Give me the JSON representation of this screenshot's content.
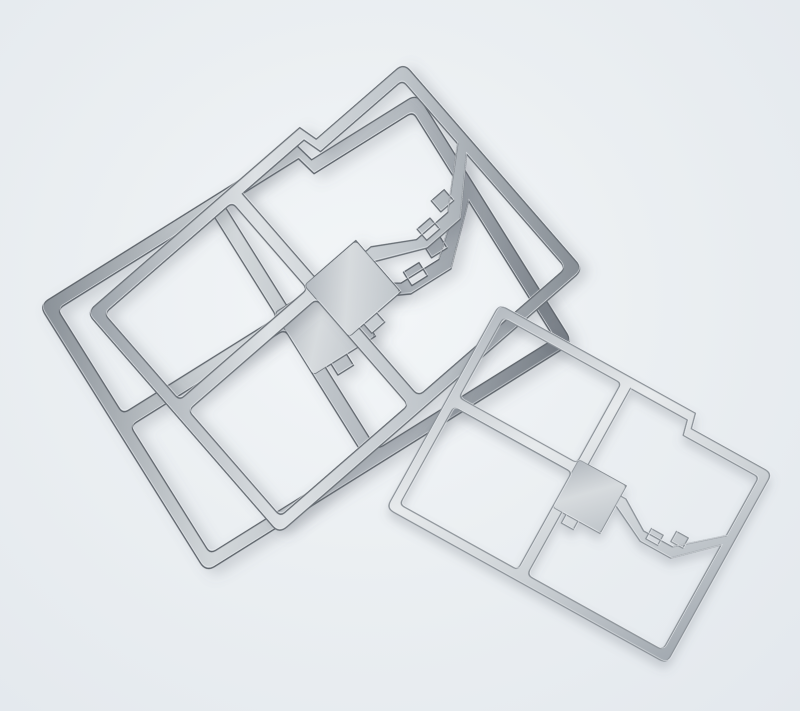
{
  "scene": {
    "kind": "product-photo",
    "subject": "stamped-metal-emi-shield-frames",
    "part_count": 3,
    "background": {
      "center": "#f3f6f8",
      "base": "#ebeff2",
      "edge": "#e3e8ed"
    },
    "palette": {
      "opening_white": "#eef1f4",
      "shadow": "rgba(96,106,116,0.25)",
      "pad_from": "#b3b9bf",
      "pad_mid": "#d7dbde",
      "pad_to": "#bfc5ca",
      "finishes": {
        "dark": {
          "stops": [
            "#899097",
            "#d2d7da",
            "#b2b8be",
            "#747b83"
          ],
          "edge": "#5d646b"
        },
        "mid": {
          "stops": [
            "#9ba2a9",
            "#dde1e4",
            "#c0c6cb",
            "#868d94"
          ],
          "edge": "#676e75"
        },
        "light": {
          "stops": [
            "#b5bbc1",
            "#e7eaec",
            "#ccd1d5",
            "#a2a9b0"
          ],
          "edge": "#8a9197"
        }
      }
    },
    "geometry": {
      "view_box": "-170 -125 340 250",
      "gradient_axis": {
        "x1": -165,
        "y1": -120,
        "x2": 165,
        "y2": 120
      },
      "outline": "M -157 -120 H 66 L 70 -104 H 157 Q 165 -104 165 -96 V 112 Q 165 120 157 120 H -157 Q -165 120 -165 112 V -112 Q -165 -120 -157 -120 Z",
      "holes": [
        "M -150 -110 H -21 Q -16 -110 -16 -105 V -21 Q -16 -16 -21 -16 H -150 Q -155 -16 -155 -21 V -105 Q -155 -110 -150 -110 Z",
        "M -150 -5 H -21 Q -16 -5 -16 0 V 105 Q -16 110 -21 110 H -150 Q -155 110 -155 105 V 0 Q -155 -5 -150 -5 Z",
        "M -5 -110 H 62 L 66 -94 H 150 Q 155 -94 155 -89 V -25 L 112 12 H 78 L 46 -8 H 40 V -20 H -5 Z",
        "M -5 36 H 40 V 3 L 80 23 H 116 L 155 -14 V 104 Q 155 110 149 110 H 1 Q -5 110 -5 104 Z"
      ],
      "solder_tabs": [
        "M 84 6 H 98 V 18 H 84 Z",
        "M 108 -4 H 122 V 8 H 108 Z",
        "M 0 36 H 14 V 46 H 0 Z"
      ],
      "center_pad": {
        "x": -16,
        "y": -20,
        "w": 56,
        "h": 56
      }
    },
    "parts": [
      {
        "id": "shield-frame-back-left",
        "cx": 306,
        "cy": 324,
        "rotation": -32,
        "scale": 1.31,
        "finish": "dark"
      },
      {
        "id": "shield-frame-front-left",
        "cx": 335,
        "cy": 291,
        "rotation": -41,
        "scale": 1.22,
        "finish": "mid"
      },
      {
        "id": "shield-frame-right",
        "cx": 583,
        "cy": 484,
        "rotation": 29,
        "scale": 0.97,
        "finish": "light"
      }
    ]
  }
}
